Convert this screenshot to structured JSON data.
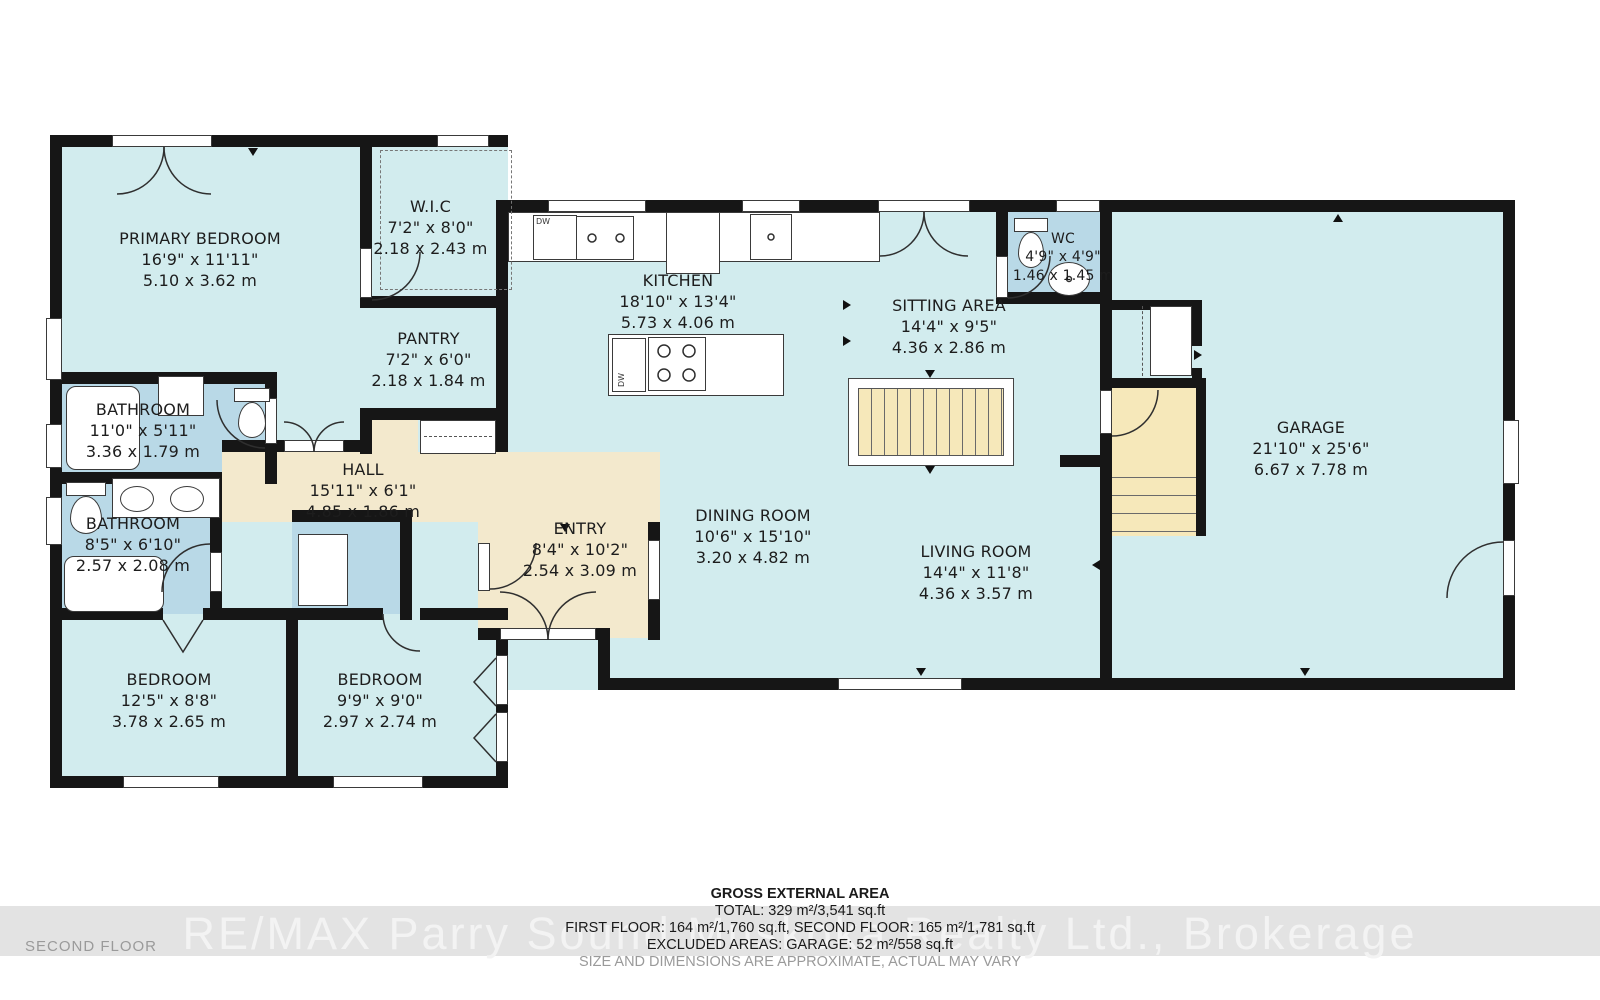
{
  "floor_label": "SECOND FLOOR",
  "watermark": "RE/MAX Parry Sound Muskoka Realty Ltd., Brokerage",
  "appliances": {
    "dishwasher": "DW"
  },
  "colors": {
    "floor": "#d2ecee",
    "wet_room": "#b9d9e7",
    "hall": "#f3e9cd",
    "stairs": "#f6e8ba",
    "wall": "#161616"
  },
  "rooms": [
    {
      "name": "PRIMARY BEDROOM",
      "imperial": "16'9\" x 11'11\"",
      "metric": "5.10 x 3.62 m"
    },
    {
      "name": "W.I.C",
      "imperial": "7'2\" x 8'0\"",
      "metric": "2.18 x 2.43 m"
    },
    {
      "name": "PANTRY",
      "imperial": "7'2\" x 6'0\"",
      "metric": "2.18 x 1.84 m"
    },
    {
      "name": "KITCHEN",
      "imperial": "18'10\" x 13'4\"",
      "metric": "5.73 x 4.06 m"
    },
    {
      "name": "SITTING AREA",
      "imperial": "14'4\" x 9'5\"",
      "metric": "4.36 x 2.86 m"
    },
    {
      "name": "WC",
      "imperial": "4'9\" x 4'9\"",
      "metric": "1.46 x 1.45 m"
    },
    {
      "name": "GARAGE",
      "imperial": "21'10\" x 25'6\"",
      "metric": "6.67 x 7.78 m"
    },
    {
      "name": "BATHROOM",
      "imperial": "11'0\" x 5'11\"",
      "metric": "3.36 x 1.79 m"
    },
    {
      "name": "HALL",
      "imperial": "15'11\" x 6'1\"",
      "metric": "4.85 x 1.86 m"
    },
    {
      "name": "BATHROOM",
      "imperial": "8'5\" x 6'10\"",
      "metric": "2.57 x 2.08 m"
    },
    {
      "name": "ENTRY",
      "imperial": "8'4\" x 10'2\"",
      "metric": "2.54 x 3.09 m"
    },
    {
      "name": "DINING ROOM",
      "imperial": "10'6\" x 15'10\"",
      "metric": "3.20 x 4.82 m"
    },
    {
      "name": "LIVING ROOM",
      "imperial": "14'4\" x 11'8\"",
      "metric": "4.36 x 3.57 m"
    },
    {
      "name": "BEDROOM",
      "imperial": "12'5\" x 8'8\"",
      "metric": "3.78 x 2.65 m"
    },
    {
      "name": "BEDROOM",
      "imperial": "9'9\" x 9'0\"",
      "metric": "2.97 x 2.74 m"
    }
  ],
  "footer": {
    "title": "GROSS EXTERNAL AREA",
    "total": "TOTAL: 329 m²/3,541 sq.ft",
    "floors": "FIRST FLOOR: 164 m²/1,760 sq.ft, SECOND FLOOR: 165 m²/1,781 sq.ft",
    "excluded": "EXCLUDED AREAS: GARAGE: 52 m²/558 sq.ft",
    "disclaimer": "SIZE AND DIMENSIONS ARE APPROXIMATE, ACTUAL MAY VARY"
  }
}
